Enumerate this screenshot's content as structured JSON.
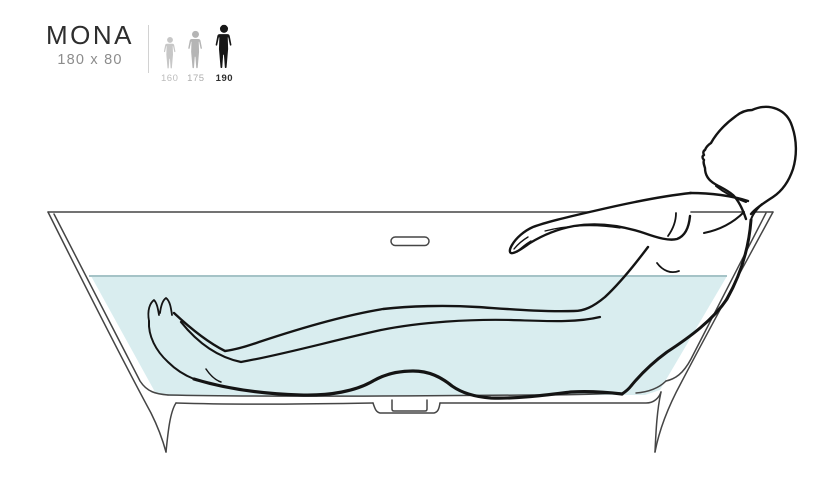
{
  "product": {
    "name": "MONA",
    "dimensions": "180 x 80"
  },
  "height_legend": {
    "options": [
      {
        "label": "160",
        "icon": "person-icon",
        "color": "#c7c7c7",
        "label_color": "#bcbcbc",
        "selected": false
      },
      {
        "label": "175",
        "icon": "person-icon",
        "color": "#b5b5b5",
        "label_color": "#adadad",
        "selected": false
      },
      {
        "label": "190",
        "icon": "person-icon",
        "color": "#171717",
        "label_color": "#2e2e2e",
        "selected": true
      }
    ]
  },
  "illustration": {
    "description": "Side cross-section of a freestanding bathtub with a reclining person, water filled to overflow level",
    "water_color": "#d9edef",
    "water_line_color": "#a5c3c7",
    "tub_line_color": "#454545",
    "figure_line_color": "#141414"
  }
}
